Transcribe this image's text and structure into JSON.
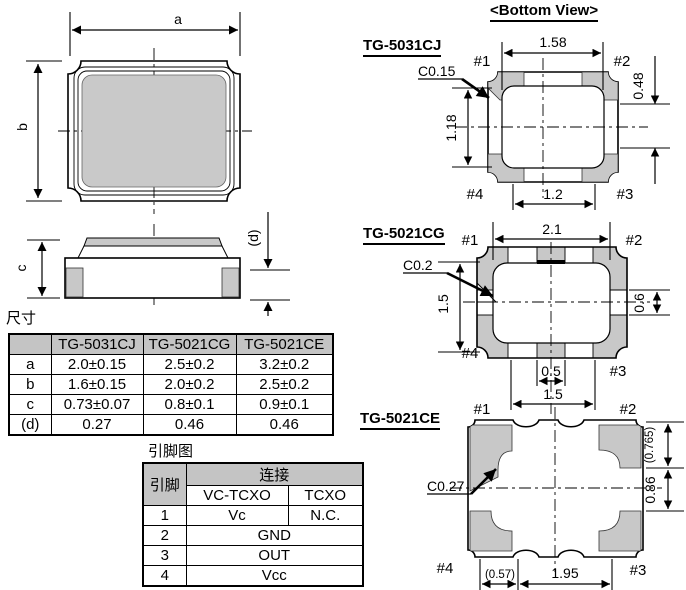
{
  "colors": {
    "pad_gray": "#c8c8c8",
    "table_header_gray": "#c4c4c4",
    "line": "#000000"
  },
  "outline_views": {
    "dim_a_label": "a",
    "dim_b_label": "b",
    "dim_c_label": "c",
    "dim_d_label": "(d)"
  },
  "dim_table": {
    "title": "尺寸",
    "headers": [
      "",
      "TG-5031CJ",
      "TG-5021CG",
      "TG-5021CE"
    ],
    "rows": [
      {
        "param": "a",
        "values": [
          "2.0±0.15",
          "2.5±0.2",
          "3.2±0.2"
        ]
      },
      {
        "param": "b",
        "values": [
          "1.6±0.15",
          "2.0±0.2",
          "2.5±0.2"
        ]
      },
      {
        "param": "c",
        "values": [
          "0.73±0.07",
          "0.8±0.1",
          "0.9±0.1"
        ]
      },
      {
        "param": "(d)",
        "values": [
          "0.27",
          "0.46",
          "0.46"
        ]
      }
    ]
  },
  "pin_table": {
    "title": "引脚图",
    "pin_col_header": "引脚",
    "connection_header": "连接",
    "sub_headers": [
      "VC-TCXO",
      "TCXO"
    ],
    "rows": [
      {
        "pin": "1",
        "vc_tcxo": "Vc",
        "tcxo": "N.C."
      },
      {
        "pin": "2",
        "shared": "GND"
      },
      {
        "pin": "3",
        "shared": "OUT"
      },
      {
        "pin": "4",
        "shared": "Vcc"
      }
    ]
  },
  "bottom_view": {
    "title": "<Bottom View>",
    "pin_labels": {
      "p1": "#1",
      "p2": "#2",
      "p3": "#3",
      "p4": "#4"
    },
    "tg5031cj": {
      "name": "TG-5031CJ",
      "chamfer": "C0.15",
      "dim_top": "1.58",
      "dim_left": "1.18",
      "dim_right": "0.48",
      "dim_bottom": "1.2"
    },
    "tg5021cg": {
      "name": "TG-5021CG",
      "chamfer": "C0.2",
      "dim_top": "2.1",
      "dim_left": "1.5",
      "dim_right": "0.6",
      "dim_bottom_inner": "0.5",
      "dim_bottom": "1.5"
    },
    "tg5021ce": {
      "name": "TG-5021CE",
      "chamfer": "C0.27",
      "dim_right_top": "(0.765)",
      "dim_right": "0.86",
      "dim_bottom_left": "(0.57)",
      "dim_bottom": "1.95"
    }
  }
}
